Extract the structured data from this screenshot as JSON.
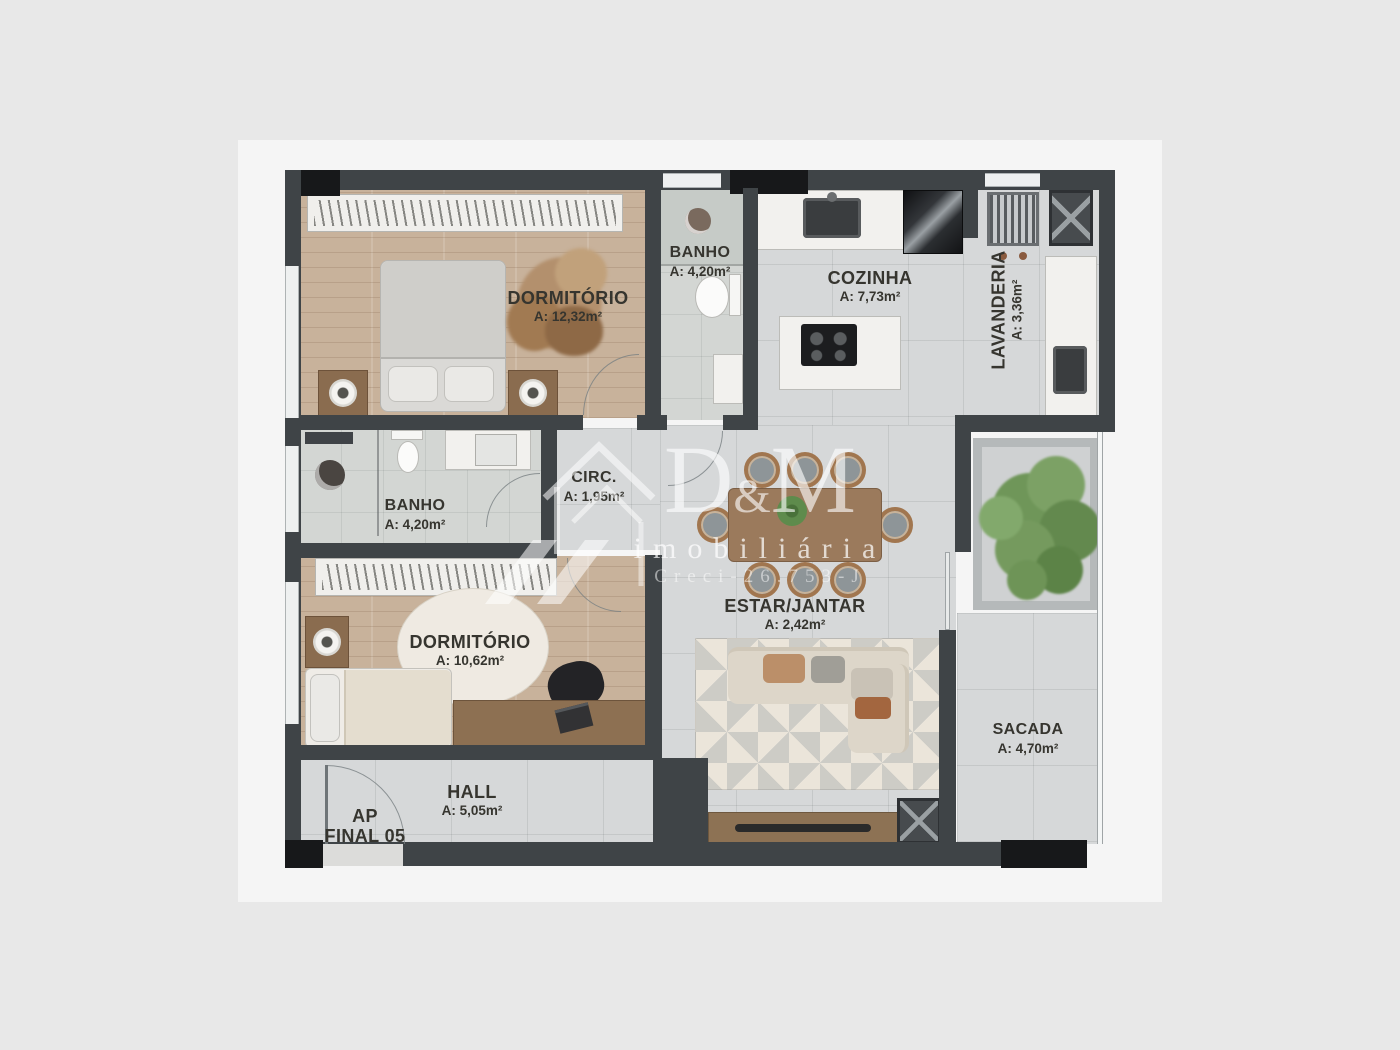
{
  "page": {
    "background": "#e8e8e8",
    "photo_background": "#f5f5f5"
  },
  "plan": {
    "wall_color": "#3f4447",
    "black_wall_color": "#17181a",
    "tile_floor_color": "#d6d8d9",
    "wood_floor_color": "#c8b29b",
    "bath_floor_color": "#d3d6d3",
    "tree_color": "#6f9659",
    "furniture_wood_color": "#8a6c4f"
  },
  "rooms": [
    {
      "id": "dormitorio-1",
      "name": "DORMITÓRIO",
      "area": "A: 12,32m²"
    },
    {
      "id": "banho-1",
      "name": "BANHO",
      "area": "A: 4,20m²"
    },
    {
      "id": "cozinha",
      "name": "COZINHA",
      "area": "A: 7,73m²"
    },
    {
      "id": "lavanderia",
      "name": "LAVANDERIA",
      "area": "A: 3,36m²"
    },
    {
      "id": "circulacao",
      "name": "CIRC.",
      "area": "A: 1,95m²"
    },
    {
      "id": "banho-2",
      "name": "BANHO",
      "area": "A: 4,20m²"
    },
    {
      "id": "dormitorio-2",
      "name": "DORMITÓRIO",
      "area": "A: 10,62m²"
    },
    {
      "id": "estar-jantar",
      "name": "ESTAR/JANTAR",
      "area": "A: 2,42m²"
    },
    {
      "id": "sacada",
      "name": "SACADA",
      "area": "A: 4,70m²"
    },
    {
      "id": "hall",
      "name": "HALL",
      "area": "A: 5,05m²"
    }
  ],
  "unit": {
    "line1": "AP",
    "line2": "FINAL 05"
  },
  "watermark": {
    "d": "D",
    "amp": "&",
    "m": "M",
    "subtitle": "imobiliária",
    "license": "Creci-26.753-J",
    "color": "rgba(255,255,255,0.62)"
  }
}
